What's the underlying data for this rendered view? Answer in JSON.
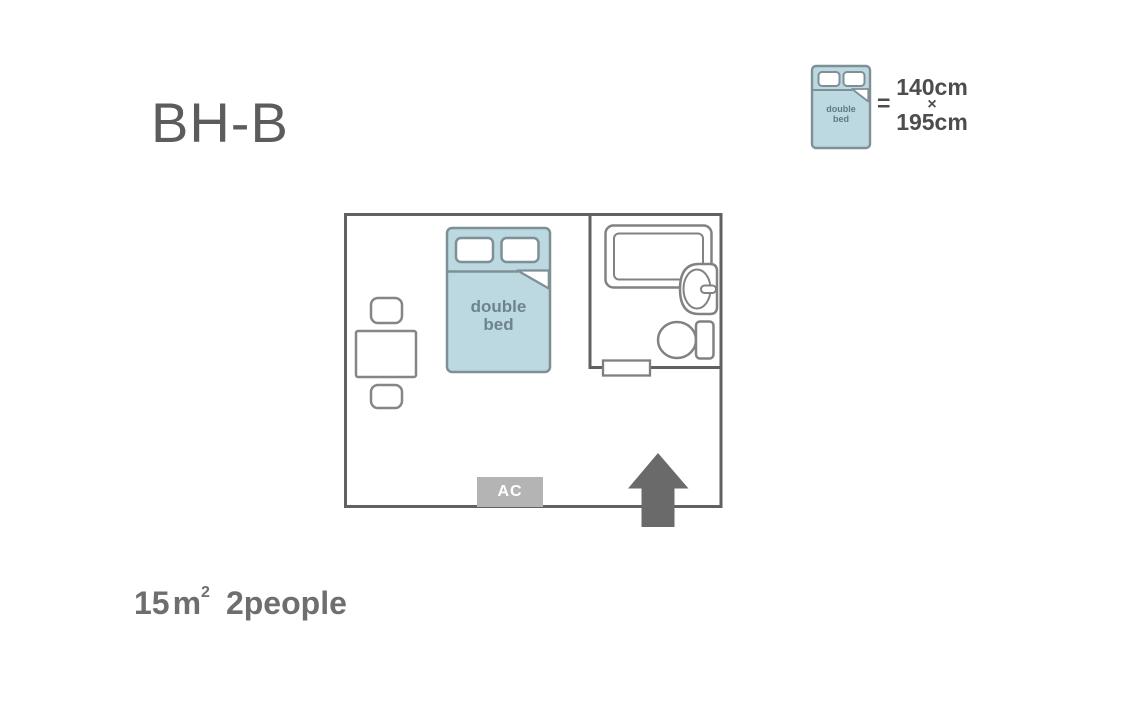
{
  "title": "BH-B",
  "legend": {
    "equals": "=",
    "width": "140cm",
    "times": "×",
    "length": "195cm",
    "bed_icon": "double-bed-icon"
  },
  "bed": {
    "label_line1": "double",
    "label_line2": "bed"
  },
  "plan": {
    "ac_label": "AC",
    "entrance_icon": "up-arrow",
    "fixtures": [
      "double-bed",
      "table",
      "stool",
      "stool",
      "bathtub",
      "sink",
      "toilet",
      "bathroom-door",
      "ac-unit",
      "entrance-arrow"
    ]
  },
  "footer": {
    "area": "15",
    "unit": "m",
    "unit_sup": "2",
    "capacity": "2people"
  },
  "colors": {
    "background": "#ffffff",
    "wall": "#616161",
    "fixture_border": "#828282",
    "bed_fill": "#bcd8e0",
    "bed_border": "#7e8f96",
    "bed_text": "#6d838d",
    "ac_fill": "#b4b4b4",
    "ac_text": "#ffffff",
    "arrow": "#6a6a6a",
    "title_text": "#5c5c5c",
    "dimension_text": "#4d4d4d",
    "footer_text": "#6e6e6e"
  }
}
